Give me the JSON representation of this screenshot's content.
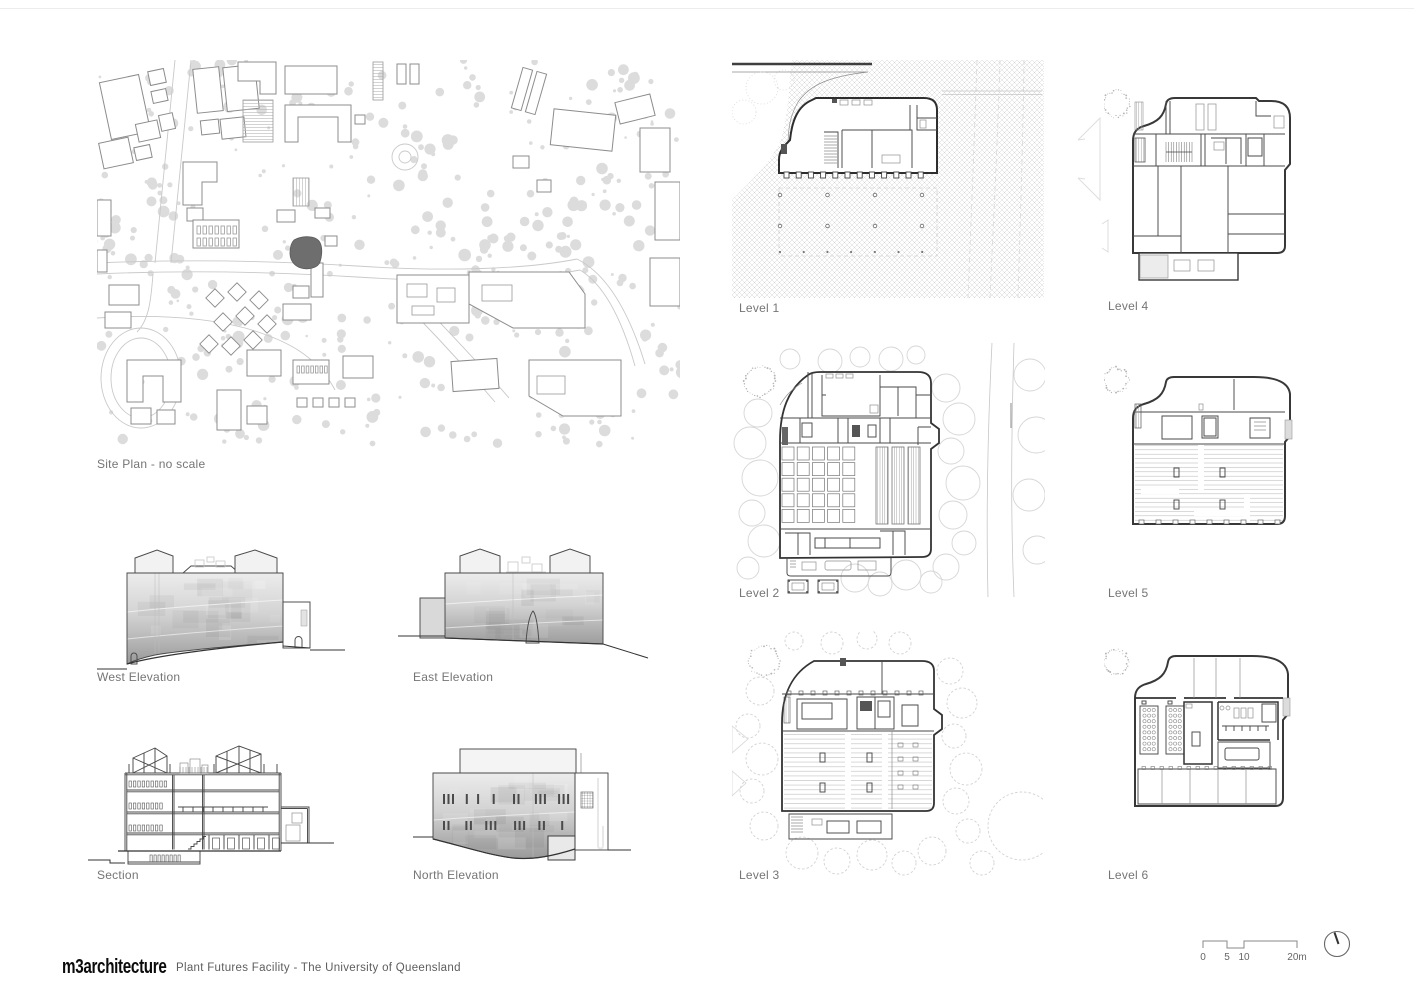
{
  "sheet": {
    "logo_text": "m3architecture",
    "project_title": "Plant Futures Facility - The University of Queensland"
  },
  "panels": {
    "site_plan": {
      "label": "Site Plan - no scale"
    },
    "west_elevation": {
      "label": "West Elevation"
    },
    "east_elevation": {
      "label": "East Elevation"
    },
    "section": {
      "label": "Section"
    },
    "north_elevation": {
      "label": "North Elevation"
    },
    "level_1": {
      "label": "Level 1"
    },
    "level_2": {
      "label": "Level 2"
    },
    "level_3": {
      "label": "Level 3"
    },
    "level_4": {
      "label": "Level 4"
    },
    "level_5": {
      "label": "Level 5"
    },
    "level_6": {
      "label": "Level 6"
    }
  },
  "scale_bar": {
    "ticks": [
      "0",
      "5",
      "10",
      "20m"
    ]
  },
  "icons": {
    "north_arrow": "north-arrow"
  },
  "colors": {
    "site_highlight": "#6e6e6e",
    "wall_dark": "#3b3b3b",
    "tree_gray": "#dcdcdc",
    "label_gray": "#757575"
  }
}
